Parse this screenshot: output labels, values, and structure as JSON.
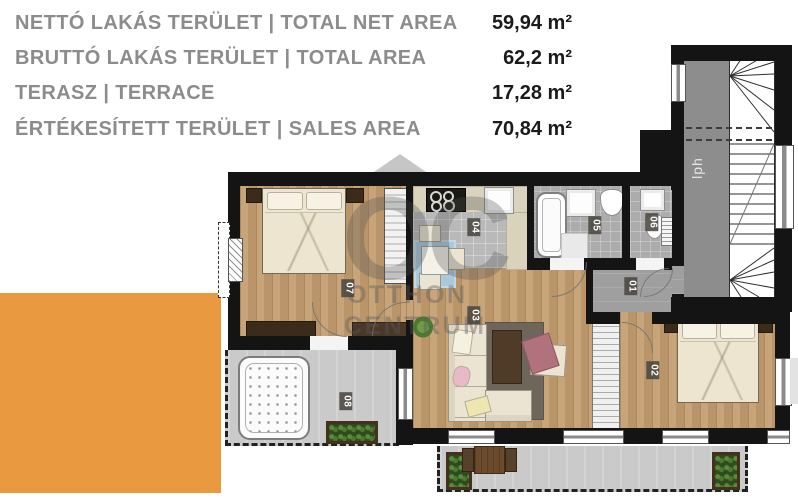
{
  "header": {
    "rows": [
      {
        "label": "NETTÓ LAKÁS TERÜLET |  TOTAL NET AREA",
        "value": "59,94 m²"
      },
      {
        "label": "BRUTTÓ LAKÁS TERÜLET |  TOTAL AREA",
        "value": "62,2 m²"
      },
      {
        "label": "TERASZ |  TERRACE",
        "value": "17,28 m²"
      },
      {
        "label": "ÉRTÉKESÍTETT TERÜLET |  SALES AREA",
        "value": "70,84 m²"
      }
    ]
  },
  "floorplan": {
    "room_labels": [
      {
        "number": "01"
      },
      {
        "number": "02"
      },
      {
        "number": "03"
      },
      {
        "number": "04"
      },
      {
        "number": "05"
      },
      {
        "number": "06"
      },
      {
        "number": "07"
      },
      {
        "number": "08"
      }
    ],
    "stairwell_label": "lph",
    "watermark": {
      "monogram": "OC",
      "line1": "OTTHON",
      "line2": "CENTRUM"
    }
  },
  "colors": {
    "accent_orange": "#E9993F",
    "wall_black": "#141414"
  }
}
